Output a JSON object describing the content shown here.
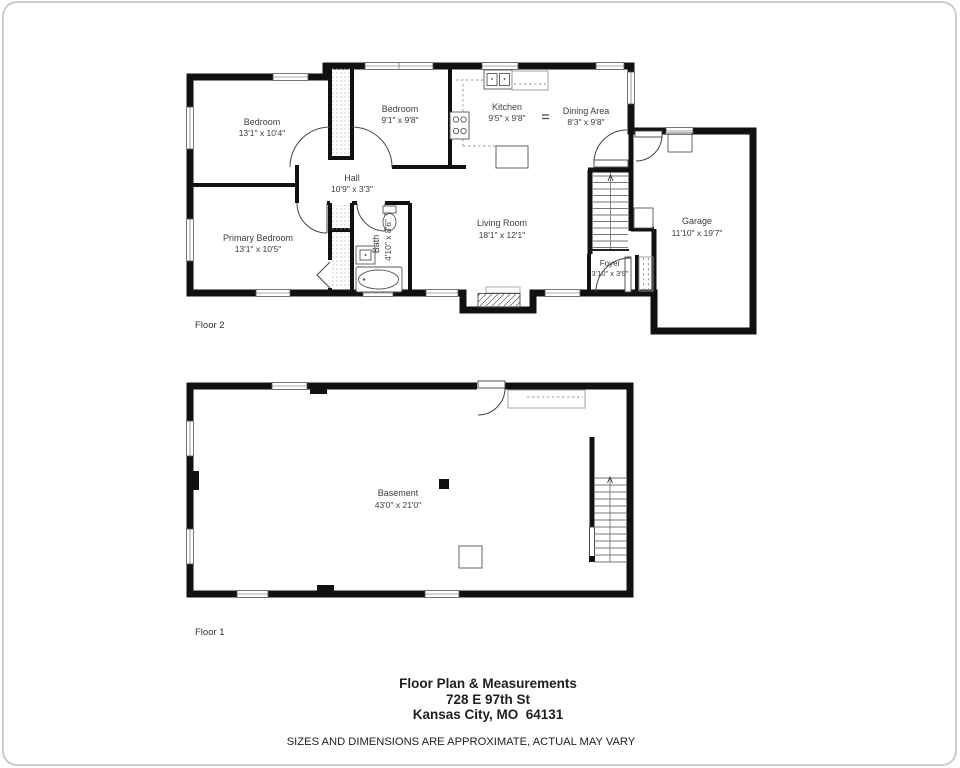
{
  "floor2": {
    "label": "Floor 2",
    "rooms": {
      "bedroom1": {
        "name": "Bedroom",
        "dims": "13'1\" x 10'4\""
      },
      "bedroom2": {
        "name": "Bedroom",
        "dims": "9'1\" x 9'8\""
      },
      "kitchen": {
        "name": "Kitchen",
        "dims": "9'5\" x 9'8\""
      },
      "dining": {
        "name": "Dining Area",
        "dims": "8'3\" x 9'8\""
      },
      "hall": {
        "name": "Hall",
        "dims": "10'9\" x 3'3\""
      },
      "primary": {
        "name": "Primary Bedroom",
        "dims": "13'1\" x 10'5\""
      },
      "bath": {
        "name": "Bath",
        "dims": "4'10\" x 8'6\""
      },
      "living": {
        "name": "Living Room",
        "dims": "18'1\" x 12'1\""
      },
      "foyer": {
        "name": "Foyer",
        "dims": "3'10\" x 3'9\""
      },
      "garage": {
        "name": "Garage",
        "dims": "11'10\" x 19'7\""
      }
    }
  },
  "floor1": {
    "label": "Floor 1",
    "rooms": {
      "basement": {
        "name": "Basement",
        "dims": "43'0\" x 21'0\""
      }
    }
  },
  "footer": {
    "title": "Floor Plan & Measurements",
    "address_line1": "728 E 97th St",
    "address_line2": "Kansas City, MO  64131",
    "disclaimer": "SIZES AND DIMENSIONS ARE APPROXIMATE, ACTUAL MAY VARY"
  },
  "colors": {
    "wall": "#111111",
    "label_text": "#3d3d3d",
    "frame_border": "#cccccc"
  }
}
